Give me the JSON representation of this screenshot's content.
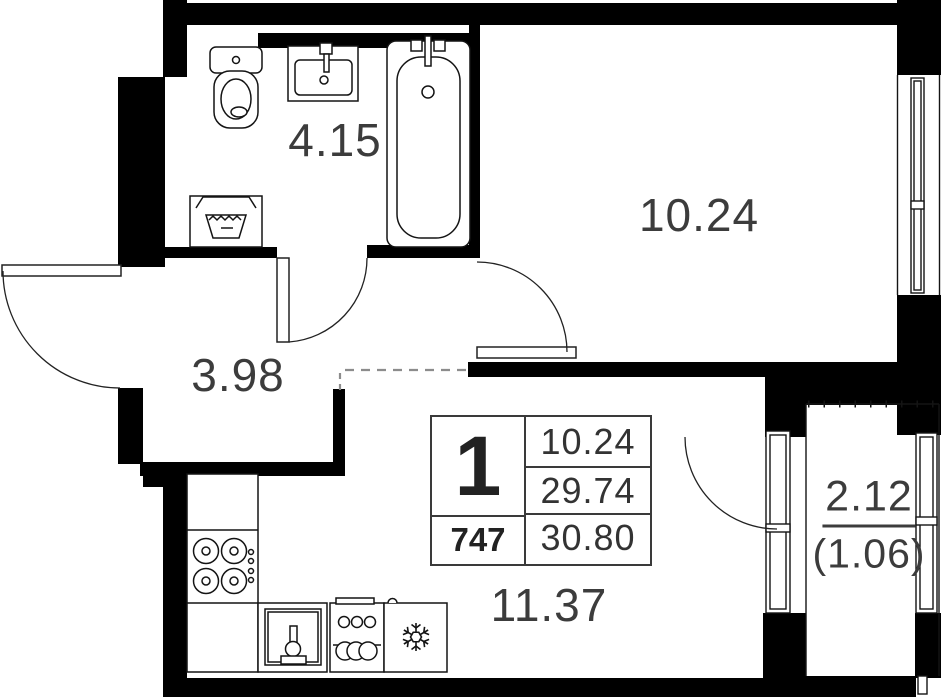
{
  "title": "apartment-floor-plan",
  "rooms": {
    "bathroom": {
      "area": "4.15"
    },
    "hallway": {
      "area": "3.98"
    },
    "living_room": {
      "area": "10.24"
    },
    "kitchen_living": {
      "area": "11.37"
    },
    "balcony": {
      "area": "2.12",
      "area_reduced": "(1.06)"
    }
  },
  "info_table": {
    "room_count": "1",
    "unit_number": "747",
    "living_area": "10.24",
    "area_without_balcony": "29.74",
    "total_area": "30.80"
  },
  "icons": [
    "toilet-icon",
    "bathroom-sink-icon",
    "bathtub-icon",
    "laundry-basket-icon",
    "stove-icon",
    "kitchen-sink-icon",
    "dishwasher-icon",
    "fridge-snowflake-icon",
    "entrance-door-arc",
    "bathroom-door-arc",
    "room-door-arc",
    "balcony-door-arc",
    "window-icon"
  ],
  "colors": {
    "wall": "#000000",
    "fixture_line": "#141414",
    "label": "#3c3c3c",
    "table_border": "#3a3a3a",
    "dash": "#8c8c8c",
    "background": "#ffffff"
  }
}
